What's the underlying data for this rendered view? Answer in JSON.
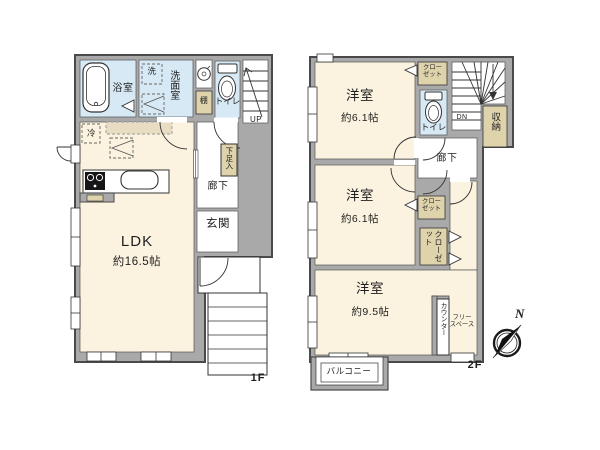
{
  "floor1": {
    "floor_label": "1F",
    "bathroom": "浴室",
    "washer": "洗",
    "washroom": "洗面室",
    "shelf": "棚",
    "toilet": "トイレ",
    "stairs_up": "UP",
    "shoe_box": "下足入",
    "hallway": "廊下",
    "entrance": "玄関",
    "ldk": "LDK",
    "ldk_size": "約16.5帖",
    "fridge": "冷"
  },
  "floor2": {
    "floor_label": "2F",
    "room1": "洋室",
    "room1_size": "約6.1帖",
    "closet1": "クロー\nゼット",
    "toilet": "トイレ",
    "stairs_down": "DN",
    "storage": "収納",
    "hallway": "廊下",
    "room2": "洋室",
    "room2_size": "約6.1帖",
    "closet2": "クロー\nゼット",
    "closet3": "クローゼット",
    "room3": "洋室",
    "room3_size": "約9.5帖",
    "counter": "カウンター",
    "free_space": "フリー\nスペース",
    "balcony": "バルコニー",
    "north": "N"
  },
  "colors": {
    "wall": "#a9a9a9",
    "wall_outline": "#4a4a4a",
    "room_cream": "#fbf3df",
    "wet_blue": "#d6e9f4",
    "storage_tan": "#dfd3ac",
    "line": "#333333"
  }
}
